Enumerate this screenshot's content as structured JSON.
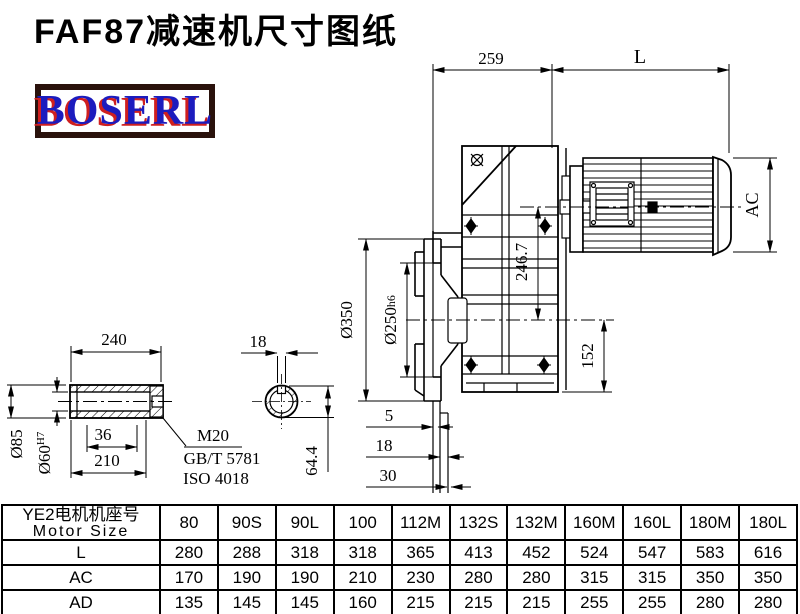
{
  "page": {
    "title": "FAF87减速机尺寸图纸",
    "logo_text": "BOSERL",
    "colors": {
      "logo_blue": "#1c1cbe",
      "logo_red_shadow": "#cf1f1f",
      "logo_border_brown": "#2a120c",
      "line_black": "#000000"
    }
  },
  "drawing": {
    "main_view": {
      "dims": {
        "gearcase_length": "259",
        "motor_length": "L",
        "motor_diameter": "AC",
        "center_height": "246.7",
        "axis_to_bottom": "152",
        "flange_od": "Ø350",
        "flange_pilot": "Ø250",
        "flange_pilot_tol": "h6",
        "flange_step_1": "5",
        "flange_step_2": "18",
        "flange_step_3": "30"
      }
    },
    "shaft_view": {
      "dims": {
        "shaft_length": "240",
        "shaft_od": "Ø85",
        "bore": "Ø60",
        "bore_tol": "H7",
        "bolt_len": "36",
        "hub_len": "210"
      },
      "notes": {
        "thread": "M20",
        "standard_gb": "GB/T 5781",
        "standard_iso": "ISO 4018"
      }
    },
    "section_view": {
      "dims": {
        "keyway_width": "18",
        "keyway_height": "64.4"
      }
    }
  },
  "table": {
    "header_cn": "YE2电机机座号",
    "header_en": "Motor Size",
    "columns": [
      "80",
      "90S",
      "90L",
      "100",
      "112M",
      "132S",
      "132M",
      "160M",
      "160L",
      "180M",
      "180L"
    ],
    "rows": [
      {
        "label": "L",
        "values": [
          "280",
          "288",
          "318",
          "318",
          "365",
          "413",
          "452",
          "524",
          "547",
          "583",
          "616"
        ]
      },
      {
        "label": "AC",
        "values": [
          "170",
          "190",
          "190",
          "210",
          "230",
          "280",
          "280",
          "315",
          "315",
          "350",
          "350"
        ]
      },
      {
        "label": "AD",
        "values": [
          "135",
          "145",
          "145",
          "160",
          "215",
          "215",
          "215",
          "255",
          "255",
          "280",
          "280"
        ]
      }
    ]
  }
}
